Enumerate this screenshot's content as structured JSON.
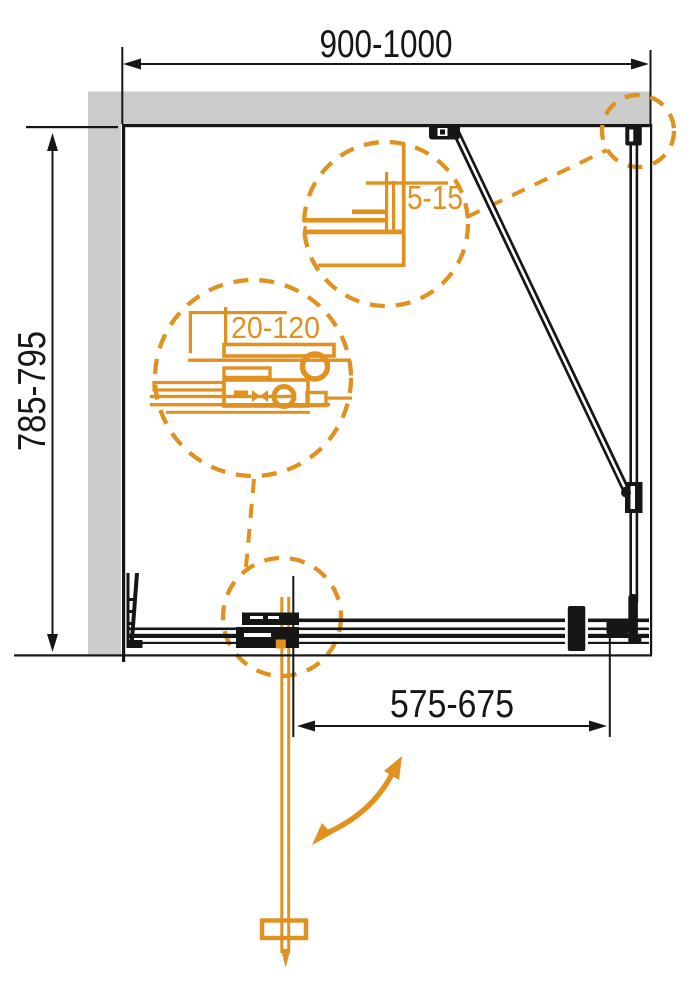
{
  "colors": {
    "accent_orange": "#E0911F",
    "wall_gray": "#CBCBCB",
    "line_black": "#161616",
    "background": "#FFFFFF"
  },
  "dimensions": {
    "enclosure_width": "900-1000",
    "enclosure_depth": "785-795",
    "door_opening_width": "575-675",
    "wall_gap_adjustment": "5-15",
    "profile_adjustment": "20-120"
  }
}
